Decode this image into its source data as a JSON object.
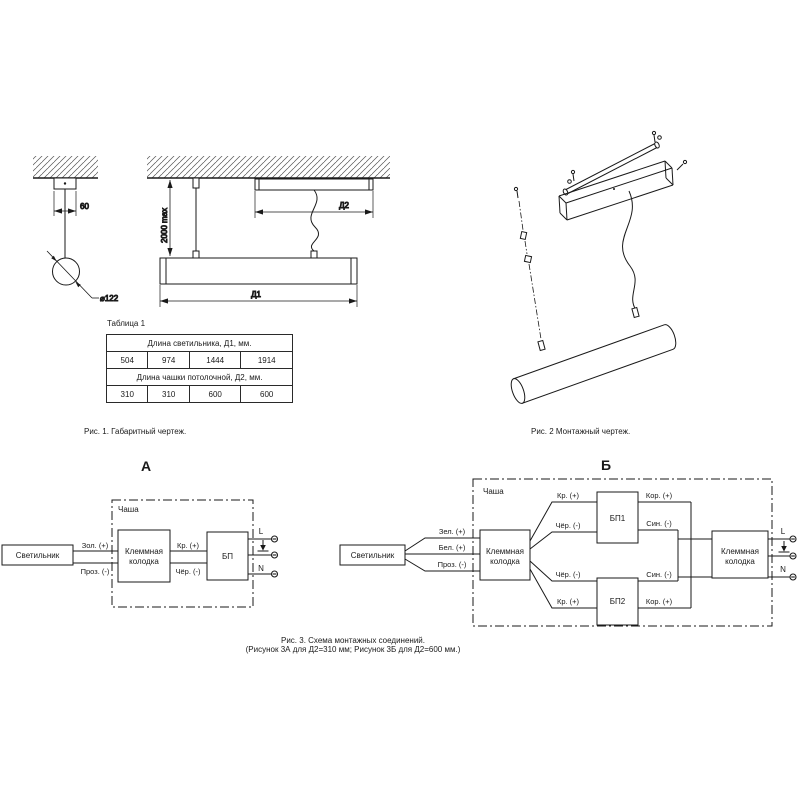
{
  "figure1": {
    "caption": "Рис. 1. Габаритный чертеж.",
    "dim_canopy_width": "60",
    "dim_diameter": "⌀122",
    "dim_suspension": "2000 max",
    "dim_luminaire_length": "Д1",
    "dim_cup_length": "Д2"
  },
  "table1": {
    "title": "Таблица 1",
    "header_d1": "Длина светильника, Д1, мм.",
    "d1_values": [
      "504",
      "974",
      "1444",
      "1914"
    ],
    "header_d2": "Длина чашки потолочной, Д2, мм.",
    "d2_values": [
      "310",
      "310",
      "600",
      "600"
    ]
  },
  "figure2": {
    "caption": "Рис. 2 Монтажный чертеж."
  },
  "figure3": {
    "caption_line1": "Рис. 3. Схема монтажных соединений.",
    "caption_line2": "(Рисунок 3А для Д2=310 мм; Рисунок 3Б для Д2=600 мм.)"
  },
  "diagram_a": {
    "title": "А",
    "luminaire_label": "Светильник",
    "cup_label": "Чаша",
    "terminal_block_line1": "Клеммная",
    "terminal_block_line2": "колодка",
    "psu_label": "БП",
    "wire_gold": "Зол. (+)",
    "wire_transparent": "Проз. (-)",
    "wire_red": "Кр. (+)",
    "wire_black": "Чёр. (-)",
    "mains_l": "L",
    "mains_n": "N"
  },
  "diagram_b": {
    "title": "Б",
    "luminaire_label": "Светильник",
    "cup_label": "Чаша",
    "terminal_block1_line1": "Клеммная",
    "terminal_block1_line2": "колодка",
    "terminal_block2_line1": "Клеммная",
    "terminal_block2_line2": "колодка",
    "psu1_label": "БП1",
    "psu2_label": "БП2",
    "wire_green": "Зел. (+)",
    "wire_white": "Бел. (+)",
    "wire_transparent": "Проз. (-)",
    "psu1_in_plus": "Кр. (+)",
    "psu1_in_minus": "Чёр. (-)",
    "psu1_out_plus": "Кор. (+)",
    "psu1_out_minus": "Син. (-)",
    "psu2_in_minus": "Чёр. (-)",
    "psu2_in_plus": "Кр. (+)",
    "psu2_out_minus": "Син. (-)",
    "psu2_out_plus": "Кор. (+)",
    "mains_l": "L",
    "mains_n": "N"
  },
  "colors": {
    "line": "#1a1a1a",
    "background": "#ffffff"
  }
}
